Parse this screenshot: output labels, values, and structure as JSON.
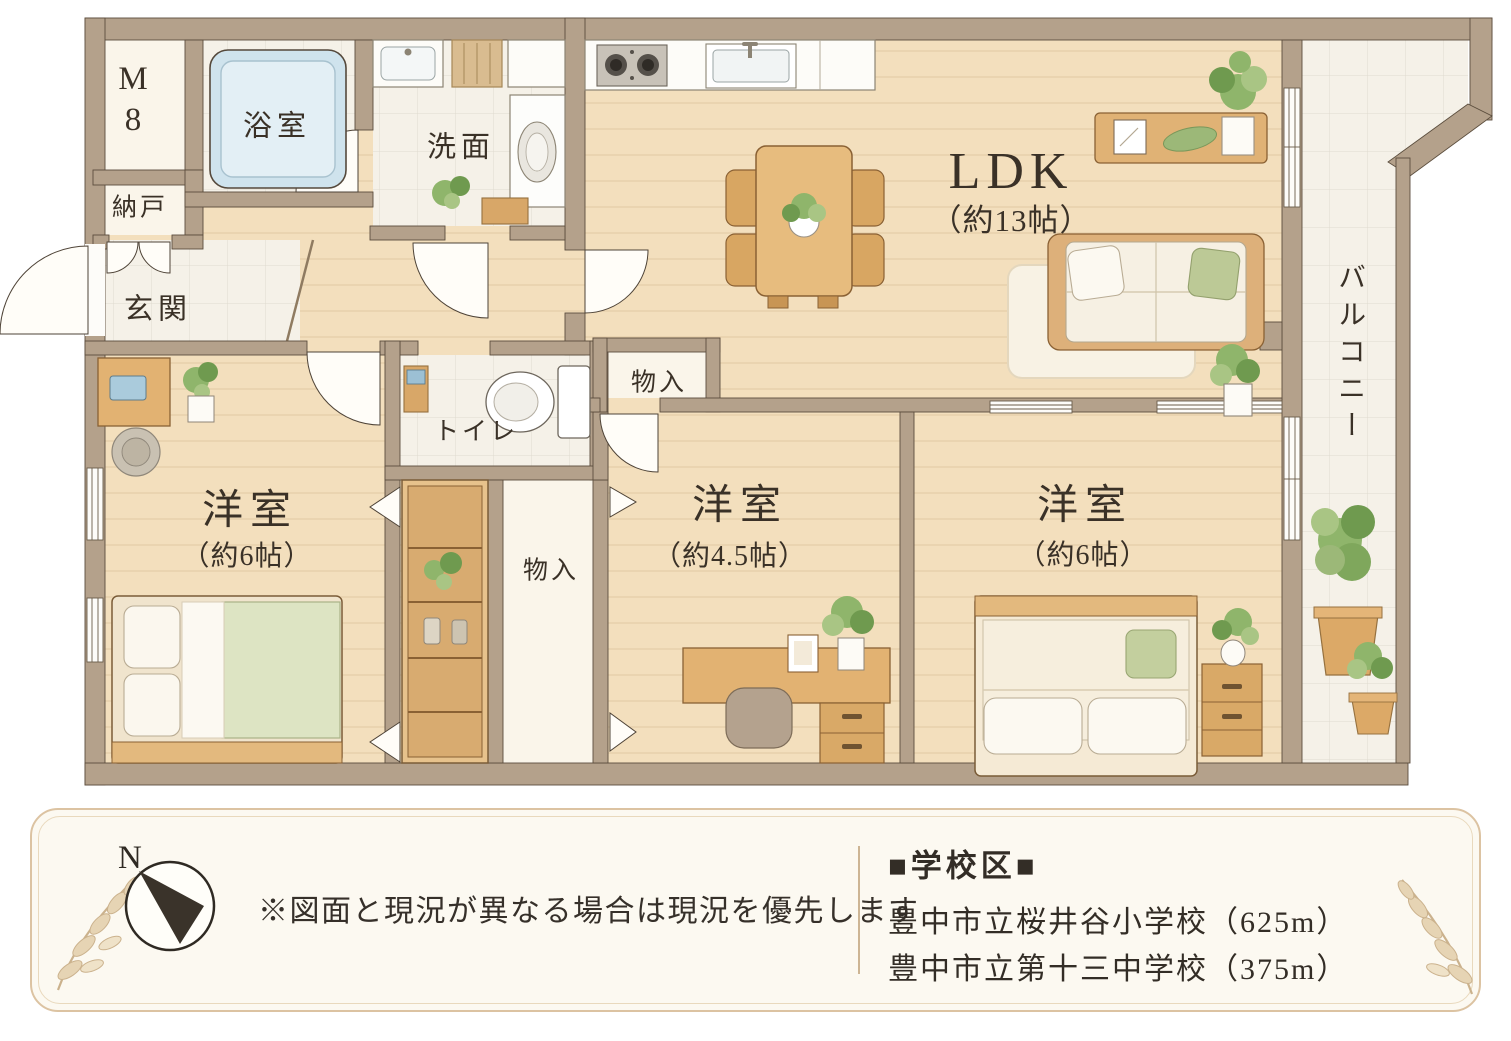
{
  "colors": {
    "wall": "#b4a18b",
    "floor_wood": "#f3dfbd",
    "tile": "#f5f1e8",
    "bathtub": "#cfe3ed",
    "plant_green": "#8fb56b",
    "text": "#3a3127",
    "bar_border": "#dcc3a2",
    "bar_background": "#fcf9f1",
    "compass_arrow": "#3a332a"
  },
  "plan": {
    "rooms": {
      "m8": {
        "line1": "M",
        "line2": "8"
      },
      "bath": {
        "label": "浴室"
      },
      "washroom": {
        "label": "洗面"
      },
      "naando": {
        "label": "納戸"
      },
      "entrance": {
        "label": "玄関"
      },
      "toilet": {
        "label": "トイレ"
      },
      "closet_top": {
        "label": "物入"
      },
      "closet_bottom": {
        "label": "物入"
      },
      "ldk": {
        "label": "LDK",
        "size": "（約13帖）"
      },
      "bedroom_left": {
        "label": "洋室",
        "size": "（約6帖）"
      },
      "bedroom_middle": {
        "label": "洋室",
        "size": "（約4.5帖）"
      },
      "bedroom_right": {
        "label": "洋室",
        "size": "（約6帖）"
      },
      "balcony": {
        "label": "バルコニー"
      }
    }
  },
  "info_bar": {
    "compass": {
      "label": "N"
    },
    "note": "※図面と現況が異なる場合は現況を優先します",
    "school_district": {
      "title": "■学校区■",
      "items": [
        "豊中市立桜井谷小学校（625m）",
        "豊中市立第十三中学校（375m）"
      ]
    }
  }
}
